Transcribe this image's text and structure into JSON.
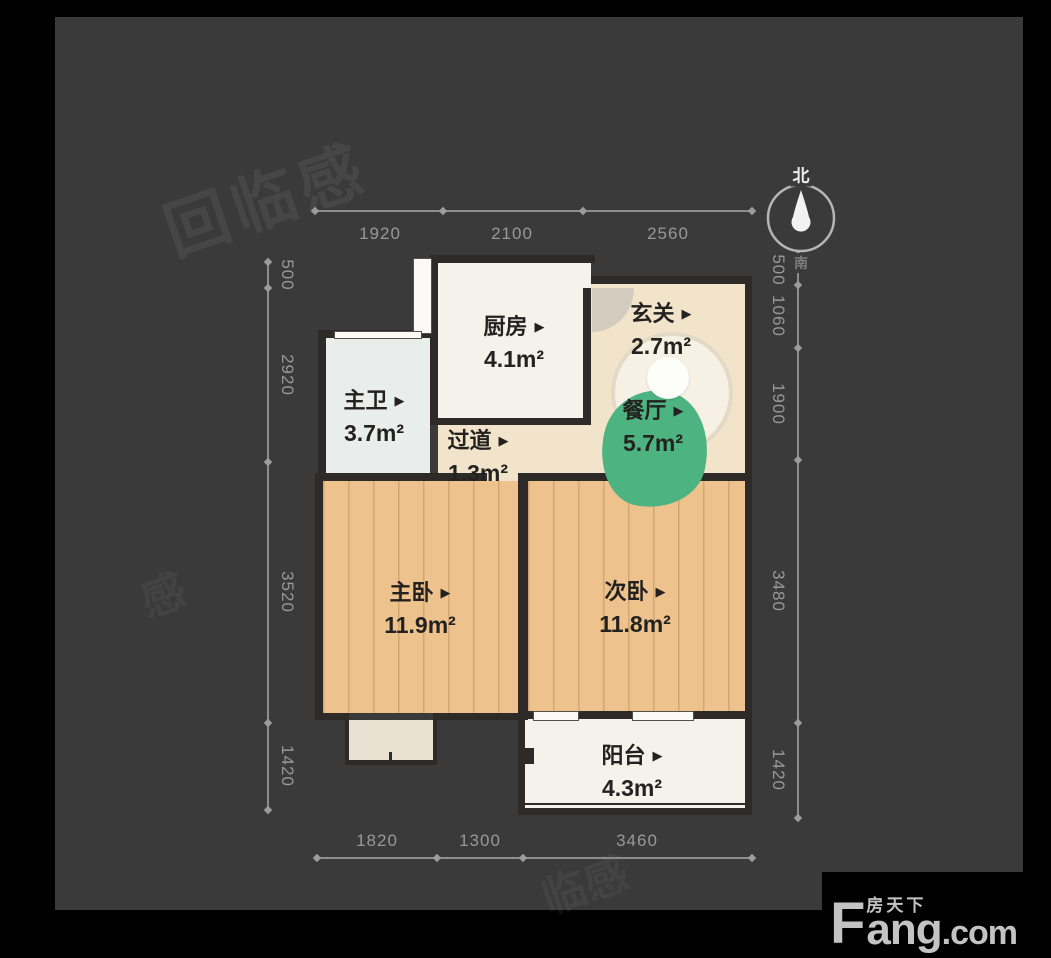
{
  "watermarks": {
    "main": "回临感",
    "small1": "感",
    "small2": "临感"
  },
  "compass": {
    "north": "北",
    "south": "南"
  },
  "rooms": [
    {
      "id": "kitchen",
      "name": "厨房",
      "area": "4.1m²"
    },
    {
      "id": "foyer",
      "name": "玄关",
      "area": "2.7m²"
    },
    {
      "id": "master-bath",
      "name": "主卫",
      "area": "3.7m²"
    },
    {
      "id": "corridor",
      "name": "过道",
      "area": "1.3m²"
    },
    {
      "id": "dining",
      "name": "餐厅",
      "area": "5.7m²"
    },
    {
      "id": "master-bedroom",
      "name": "主卧",
      "area": "11.9m²"
    },
    {
      "id": "second-bedroom",
      "name": "次卧",
      "area": "11.8m²"
    },
    {
      "id": "balcony",
      "name": "阳台",
      "area": "4.3m²"
    }
  ],
  "dimensions": {
    "top": [
      "1920",
      "2100",
      "2560"
    ],
    "bottom": [
      "1820",
      "1300",
      "3460"
    ],
    "left": [
      "500",
      "2920",
      "3520",
      "1420"
    ],
    "right": [
      "500",
      "1060",
      "1900",
      "3480",
      "1420"
    ]
  },
  "logo": {
    "f": "F",
    "cn": "房天下",
    "ang": "ang",
    "dotcom": ".com"
  },
  "colors": {
    "background": "#000000",
    "panel": "#3a3a3a",
    "wall": "#2d2a27",
    "wood_floor": "#edc28c",
    "beige_floor": "#f1e4ca",
    "white_floor": "#f5f2eb",
    "bath_floor": "#e9eeec",
    "accent_green": "#4db381",
    "dim_text": "#989898"
  }
}
